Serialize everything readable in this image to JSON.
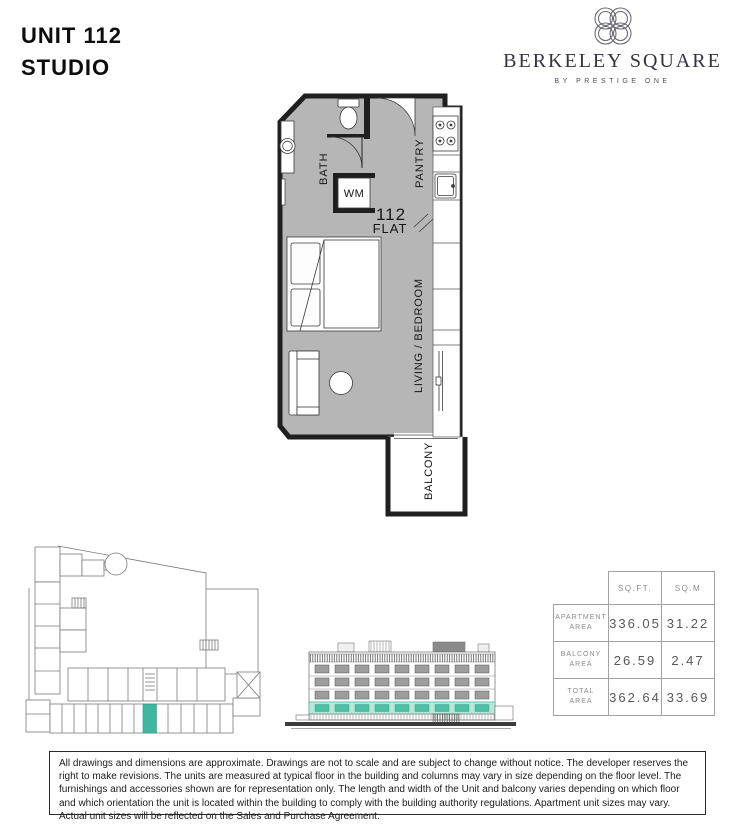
{
  "header": {
    "unit_title": "UNIT 112",
    "unit_type": "STUDIO"
  },
  "brand": {
    "name": "BERKELEY SQUARE",
    "tagline": "BY PRESTIGE ONE"
  },
  "floor_plan": {
    "labels": {
      "bath": "BATH",
      "pantry": "PANTRY",
      "wm": "WM",
      "unit_number": "112",
      "flat": "FLAT",
      "living_bedroom": "LIVING / BEDROOM",
      "balcony": "BALCONY"
    }
  },
  "area_table": {
    "headers": {
      "sqft": "SQ.FT.",
      "sqm": "SQ.M"
    },
    "rows": [
      {
        "label_line1": "APARTMENT",
        "label_line2": "AREA",
        "sqft": "336.05",
        "sqm": "31.22"
      },
      {
        "label_line1": "BALCONY",
        "label_line2": "AREA",
        "sqft": "26.59",
        "sqm": "2.47"
      },
      {
        "label_line1": "TOTAL",
        "label_line2": "AREA",
        "sqft": "362.64",
        "sqm": "33.69"
      }
    ]
  },
  "disclaimer": "All drawings and dimensions are approximate. Drawings are not to scale and are subject to change without notice. The developer reserves the right to make revisions. The units are measured at typical floor in the building and columns may vary in size depending on the floor level. The furnishings and accessories shown are for representation only. The length and width of the Unit and balcony varies depending on which floor and which orientation the unit is located within the building to comply with the building authority regulations. Apartment unit sizes may vary. Actual unit sizes will be reflected on the Sales and Purchase Agreement.",
  "colors": {
    "highlight_teal": "#3FB79C",
    "elevation_teal_band": "#B9E6D9",
    "floor_gray": "#B6B6B6",
    "wall_black": "#1F1F1F"
  }
}
